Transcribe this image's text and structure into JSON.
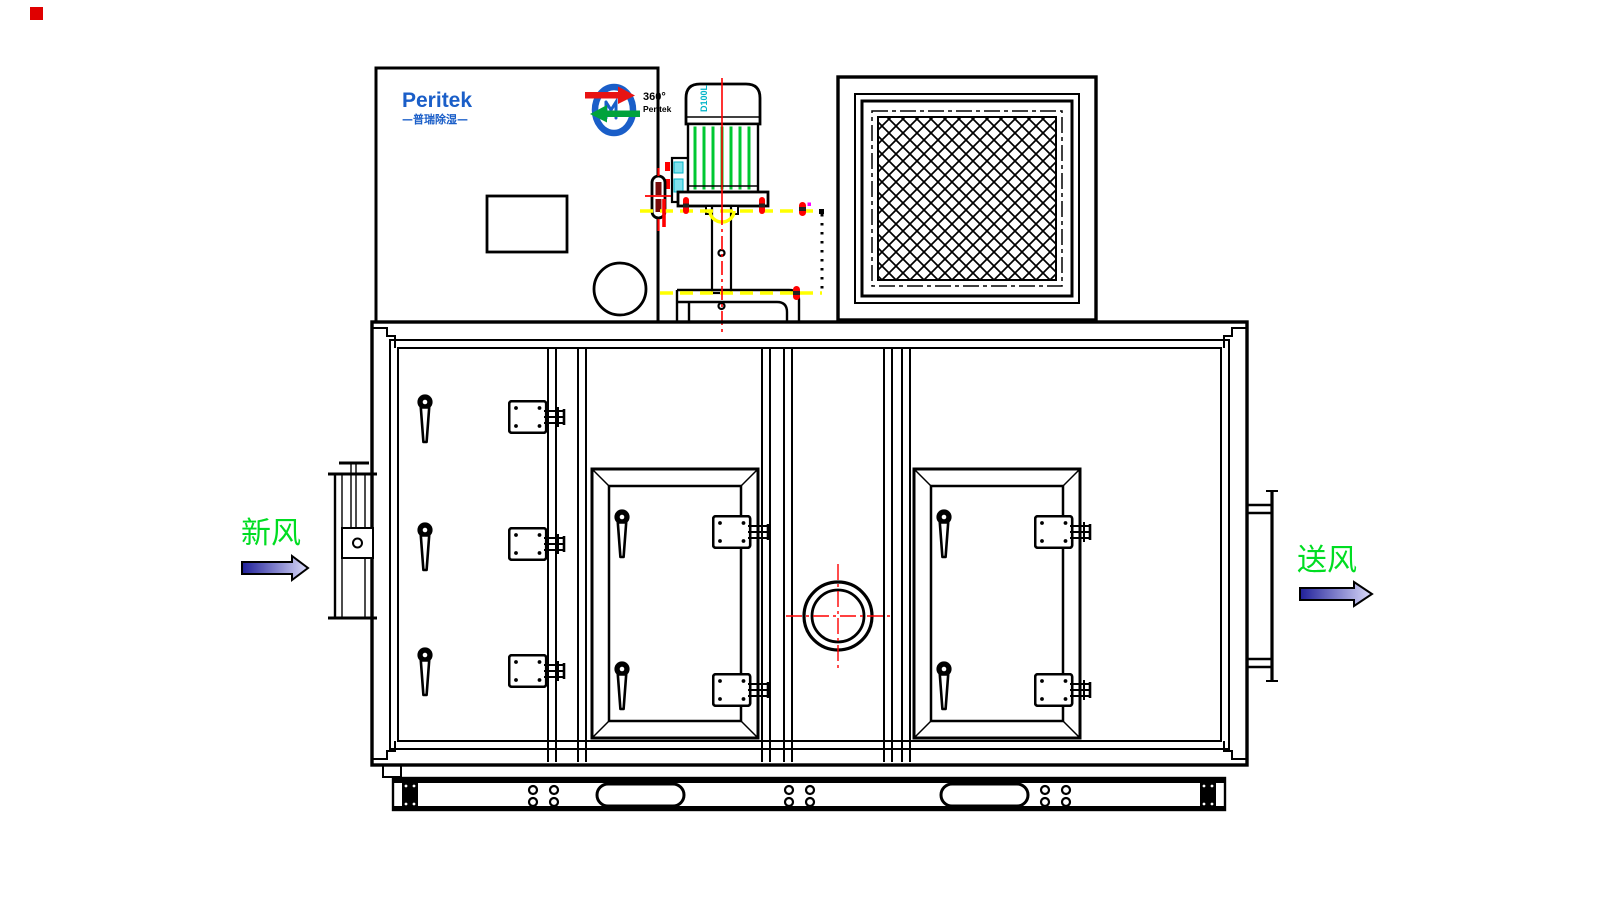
{
  "logo": {
    "name": "Peritek",
    "tagline": "—普瑞除湿—"
  },
  "rotor_badge": {
    "degree": "360°",
    "brand": "Peritek"
  },
  "motor": {
    "frame_label": "D100L"
  },
  "flow": {
    "inlet_label": "新风",
    "outlet_label": "送风"
  },
  "colors": {
    "line_black": "#000000",
    "centerline_red": "#ff0000",
    "dimension_yellow": "#ffff00",
    "flow_label_green": "#00dd22",
    "logo_blue": "#1a5ec8",
    "rotor_arrow_red": "#e81313",
    "rotor_arrow_green": "#00a23c",
    "motor_fin_green": "#00c832",
    "motor_label_cyan": "#00b4c8",
    "arrow_fill_dark": "#202099",
    "arrow_fill_light": "#dcdcfa",
    "highlight_magenta": "#ff00ff"
  }
}
